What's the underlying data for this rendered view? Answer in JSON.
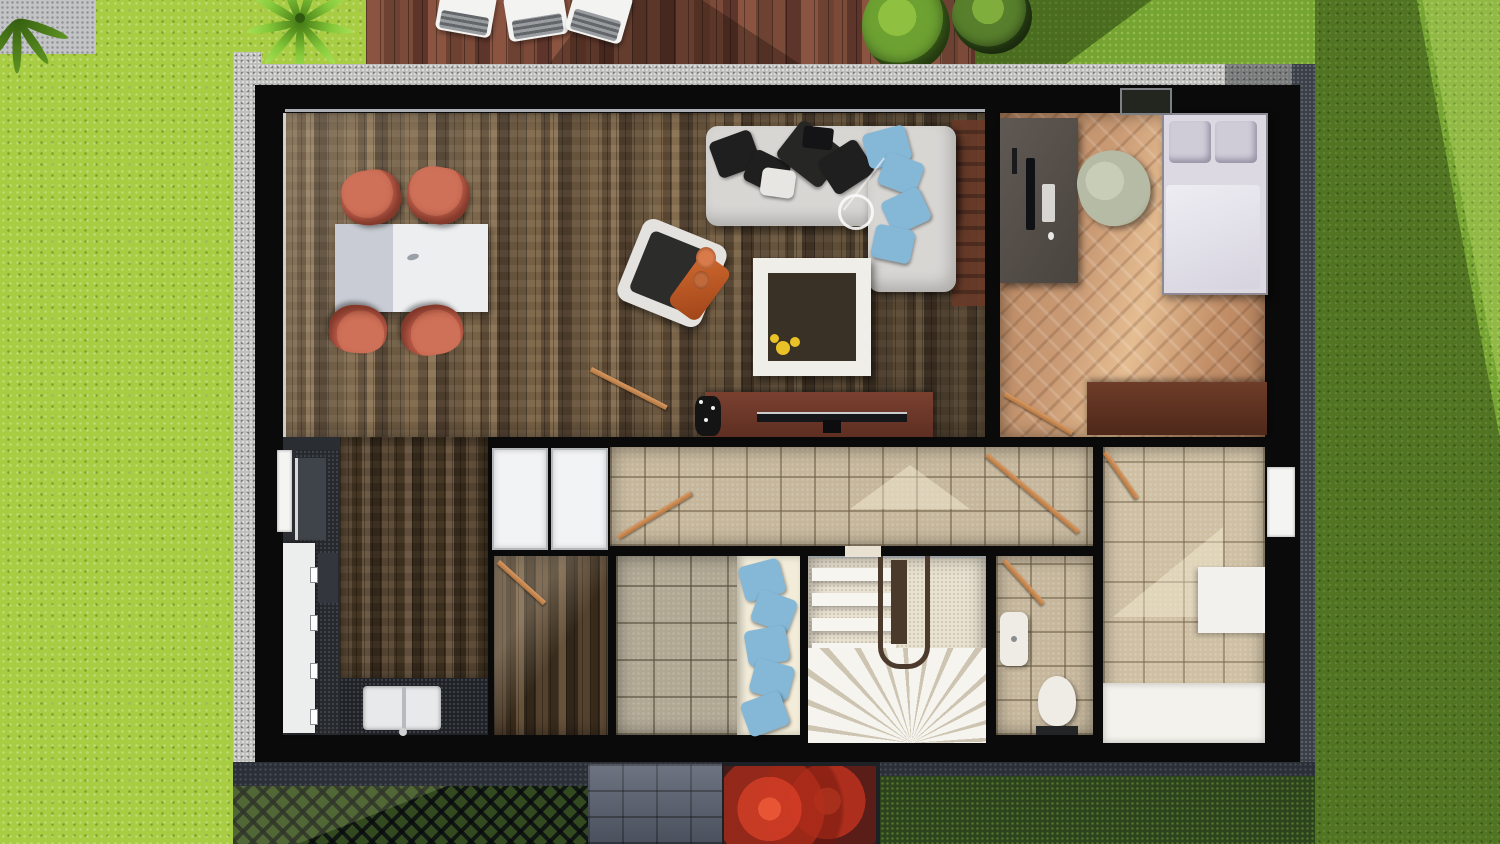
{
  "meta": {
    "description": "Top-down 3D architectural render of a single-storey house floor plan surrounded by lawn, wooden deck and paths",
    "view": "top-down",
    "visible_text": []
  },
  "palette": {
    "grassBright": "#a8cc42",
    "grassMid": "#76a432",
    "grassShadow": "#4e7a22",
    "roofBlack": "#0a0a0b",
    "deckWood": "#7c4a37",
    "gravel": "#bdbdb9",
    "pathPaver": "#5a6170",
    "bushRed": "#c23222",
    "hedgeDark": "#2c431d",
    "floorLiving": "#6b563f",
    "floorBedroom": "#c09070",
    "tileHall": "#c6b79c",
    "tileGray": "#b1a894",
    "tileBath": "#cfc0a4",
    "counterDark": "#1f2227",
    "cabinetWhite": "#eceded",
    "sofaWhite": "#d8d6d3",
    "pillowBlue": "#85b7d7",
    "chairCoral": "#cf7058",
    "tableWhite": "#eceef0",
    "fireplaceWhite": "#f0eee8",
    "fireplaceInner": "#3a3126",
    "flowerYellow": "#e9c227",
    "blanketOrange": "#bf5a2a",
    "tvWood": "#6e3424",
    "deskGray": "#57504b",
    "beanbagSage": "#b5bba5",
    "bedWhite": "#dcd9e2",
    "dresserWood": "#5f3524",
    "stairCream": "#e9e2d2",
    "railBrown": "#4c3a2c",
    "daybedCream": "#f2ecd9",
    "toiletWhite": "#efece6",
    "doorWood": "#c98a58"
  },
  "rooms": [
    {
      "name": "living-dining-room",
      "floor": "dark wood strips",
      "furniture": [
        "dining-table",
        "four-coral-chairs",
        "armchair-with-orange-throw",
        "l-shaped-sofa",
        "fireplace",
        "tv-sideboard",
        "ceiling-lamp"
      ]
    },
    {
      "name": "bedroom-office",
      "floor": "light herringbone parquet",
      "furniture": [
        "desk-with-monitor",
        "beanbag",
        "double-bed",
        "dresser"
      ]
    },
    {
      "name": "kitchen",
      "floor": "dark wood and charcoal tile",
      "furniture": [
        "white-cabinets",
        "appliance-block",
        "double-sink-counter"
      ]
    },
    {
      "name": "hallway",
      "floor": "beige tiles",
      "furniture": [
        "white-closet-doors"
      ]
    },
    {
      "name": "pantry",
      "floor": "dark wood"
    },
    {
      "name": "daybed-room",
      "floor": "gray-beige tiles",
      "furniture": [
        "daybed-with-blue-pillows"
      ]
    },
    {
      "name": "stairwell",
      "furniture": [
        "straight-treads",
        "winder-fan-treads",
        "u-handrail"
      ]
    },
    {
      "name": "wc",
      "furniture": [
        "toilet",
        "small-sink"
      ]
    },
    {
      "name": "bathroom",
      "furniture": [
        "white-cabinet",
        "bathtub"
      ]
    }
  ],
  "exterior": [
    {
      "name": "lawn",
      "zones": [
        "bright-sunlit-left",
        "shadowed-right",
        "dark-bottom"
      ]
    },
    {
      "name": "wood-deck",
      "items": [
        "three-white-loungers",
        "two-green-bushes",
        "palm-plant"
      ]
    },
    {
      "name": "gravel-border"
    },
    {
      "name": "paver-path"
    },
    {
      "name": "red-bush"
    },
    {
      "name": "lattice-trellis"
    },
    {
      "name": "hedge"
    }
  ]
}
